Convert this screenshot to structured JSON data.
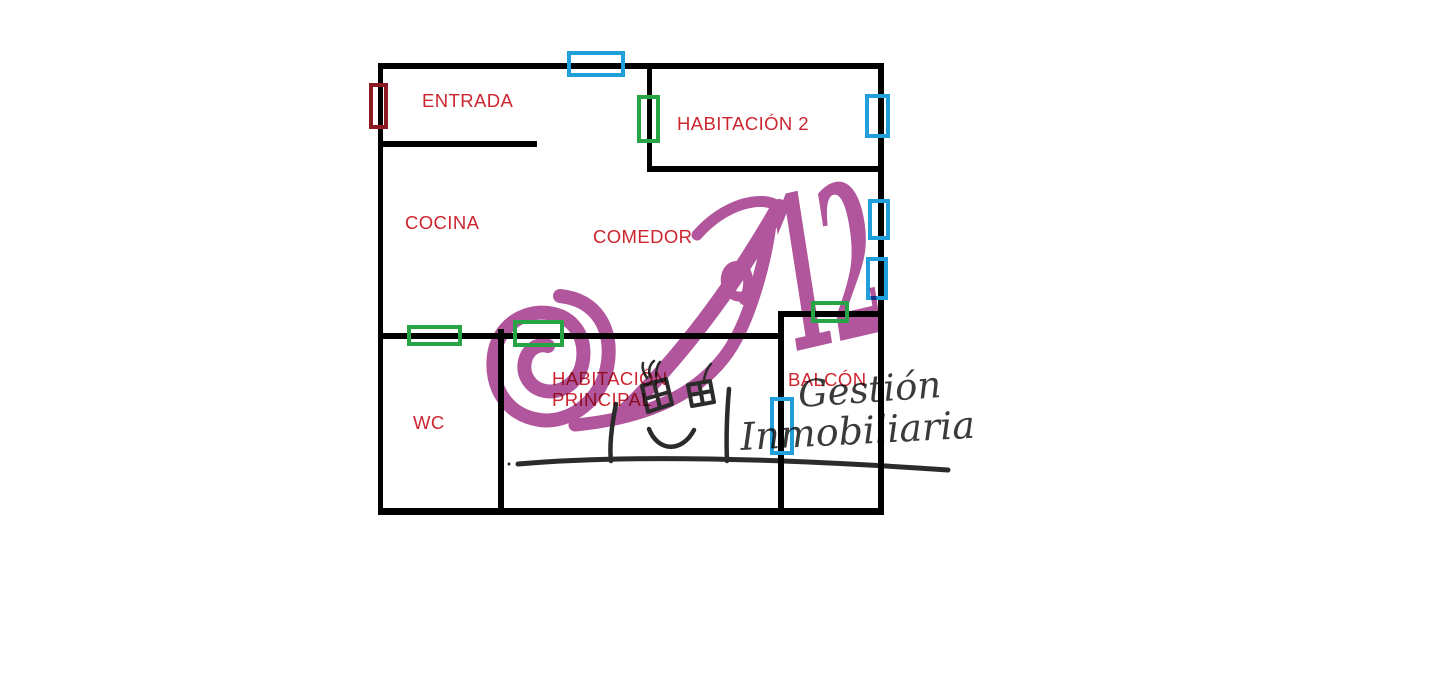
{
  "document": {
    "type": "floor-plan",
    "background": "#ffffff"
  },
  "colors": {
    "wall": "#000000",
    "room_label": "#cc2630",
    "window": "#219fdb",
    "interior_door": "#27a546",
    "entry_door": "#8b1a22",
    "watermark_purple": "#b1559c",
    "watermark_script": "#3a3a3a",
    "sketch": "#2b2b2b"
  },
  "rooms": {
    "entrada": "ENTRADA",
    "habitacion2": "HABITACIÓN 2",
    "cocina": "COCINA",
    "comedor": "COMEDOR",
    "habprincipal_l1": "HABITACIÓN",
    "habprincipal_l2": "PRINCIPAL",
    "balcon": "BALCÓN",
    "wc": "WC"
  },
  "watermark": {
    "brand_letter": "A",
    "brand_number": "12",
    "gestion": "Gestión",
    "inmobiliaria": "Inmobiliaria"
  },
  "legend_semantics": {
    "blue_rectangles": "window",
    "green_rectangles": "interior-door",
    "dark_red_rectangle": "entry-door"
  }
}
